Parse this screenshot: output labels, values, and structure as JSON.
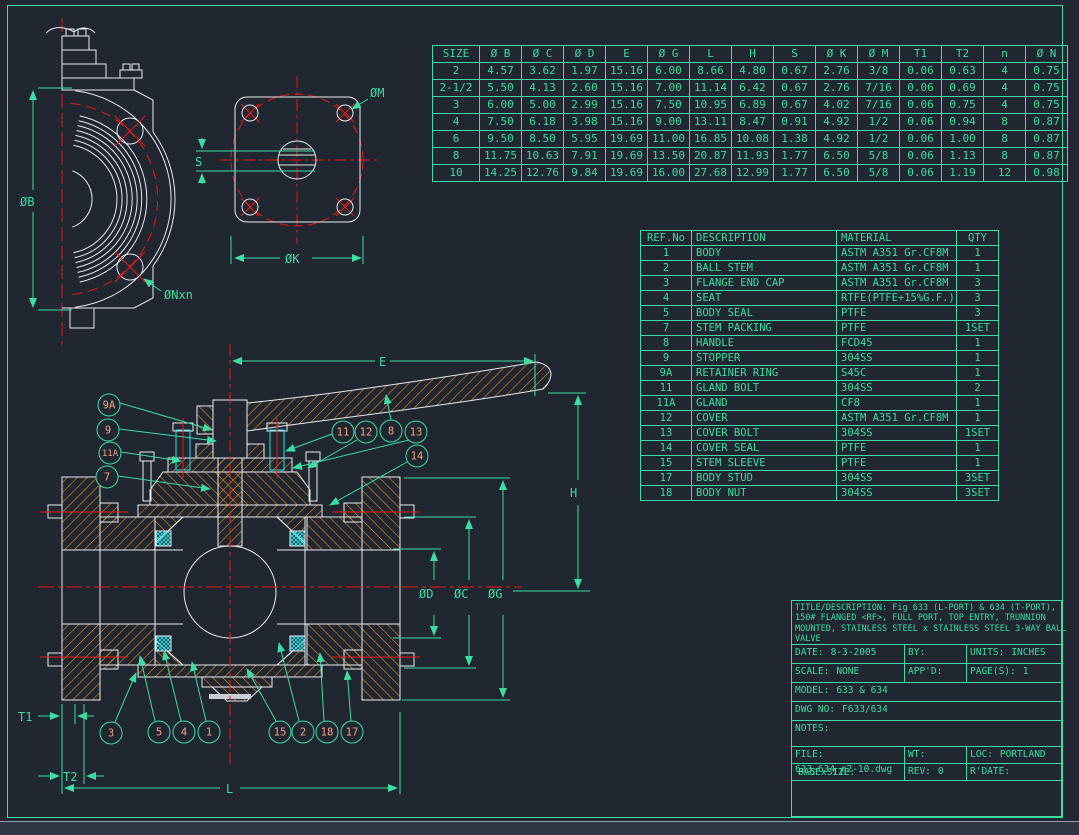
{
  "colors": {
    "background": "#202730",
    "green": "#3CDCA4",
    "white": "#E8ECEF",
    "red": "#E81818",
    "orange": "#E98A1B",
    "cyan": "#25E0E8",
    "salmon": "#F0A183",
    "taskbar": "#2E3642"
  },
  "size_table": {
    "headers": [
      "SIZE",
      "Ø B",
      "Ø C",
      "Ø D",
      "E",
      "Ø G",
      "L",
      "H",
      "S",
      "Ø K",
      "Ø M",
      "T1",
      "T2",
      "n",
      "Ø N"
    ],
    "rows": [
      [
        "2",
        "4.57",
        "3.62",
        "1.97",
        "15.16",
        "6.00",
        "8.66",
        "4.80",
        "0.67",
        "2.76",
        "3/8",
        "0.06",
        "0.63",
        "4",
        "0.75"
      ],
      [
        "2-1/2",
        "5.50",
        "4.13",
        "2.60",
        "15.16",
        "7.00",
        "11.14",
        "6.42",
        "0.67",
        "2.76",
        "7/16",
        "0.06",
        "0.69",
        "4",
        "0.75"
      ],
      [
        "3",
        "6.00",
        "5.00",
        "2.99",
        "15.16",
        "7.50",
        "10.95",
        "6.89",
        "0.67",
        "4.02",
        "7/16",
        "0.06",
        "0.75",
        "4",
        "0.75"
      ],
      [
        "4",
        "7.50",
        "6.18",
        "3.98",
        "15.16",
        "9.00",
        "13.11",
        "8.47",
        "0.91",
        "4.92",
        "1/2",
        "0.06",
        "0.94",
        "8",
        "0.87"
      ],
      [
        "6",
        "9.50",
        "8.50",
        "5.95",
        "19.69",
        "11.00",
        "16.85",
        "10.08",
        "1.38",
        "4.92",
        "1/2",
        "0.06",
        "1.00",
        "8",
        "0.87"
      ],
      [
        "8",
        "11.75",
        "10.63",
        "7.91",
        "19.69",
        "13.50",
        "20.87",
        "11.93",
        "1.77",
        "6.50",
        "5/8",
        "0.06",
        "1.13",
        "8",
        "0.87"
      ],
      [
        "10",
        "14.25",
        "12.76",
        "9.84",
        "19.69",
        "16.00",
        "27.68",
        "12.99",
        "1.77",
        "6.50",
        "5/8",
        "0.06",
        "1.19",
        "12",
        "0.98"
      ]
    ]
  },
  "bom_table": {
    "headers": [
      "REF.No",
      "DESCRIPTION",
      "MATERIAL",
      "QTY"
    ],
    "rows": [
      [
        "1",
        "BODY",
        "ASTM A351 Gr.CF8M",
        "1"
      ],
      [
        "2",
        "BALL STEM",
        "ASTM A351 Gr.CF8M",
        "1"
      ],
      [
        "3",
        "FLANGE END CAP",
        "ASTM A351 Gr.CF8M",
        "3"
      ],
      [
        "4",
        "SEAT",
        "RTFE(PTFE+15%G.F.)",
        "3"
      ],
      [
        "5",
        "BODY SEAL",
        "PTFE",
        "3"
      ],
      [
        "7",
        "STEM PACKING",
        "PTFE",
        "1SET"
      ],
      [
        "8",
        "HANDLE",
        "FCD45",
        "1"
      ],
      [
        "9",
        "STOPPER",
        "304SS",
        "1"
      ],
      [
        "9A",
        "RETAINER RING",
        "S45C",
        "1"
      ],
      [
        "11",
        "GLAND BOLT",
        "304SS",
        "2"
      ],
      [
        "11A",
        "GLAND",
        "CF8",
        "1"
      ],
      [
        "12",
        "COVER",
        "ASTM A351 Gr.CF8M",
        "1"
      ],
      [
        "13",
        "COVER BOLT",
        "304SS",
        "1SET"
      ],
      [
        "14",
        "COVER SEAL",
        "PTFE",
        "1"
      ],
      [
        "15",
        "STEM SLEEVE",
        "PTFE",
        "1"
      ],
      [
        "17",
        "BODY STUD",
        "304SS",
        "3SET"
      ],
      [
        "18",
        "BODY NUT",
        "304SS",
        "3SET"
      ]
    ]
  },
  "title_block": {
    "title_lines": [
      "TITLE/DESCRIPTION: Fig 633 (L-PORT) & 634 (T-PORT),",
      "150# FLANGED <RF>, FULL PORT, TOP ENTRY, TRUNNION",
      "MOUNTED, STAINLESS STEEL x STAINLESS STEEL 3-WAY BALL",
      "VALVE"
    ],
    "date_label": "DATE:",
    "date": "8-3-2005",
    "by_label": "BY:",
    "units_label": "UNITS:",
    "units": "INCHES",
    "scale_label": "SCALE:",
    "scale": "NONE",
    "appd_label": "APP'D:",
    "pages_label": "PAGE(S):",
    "pages": "1",
    "model_label": "MODEL:",
    "model": "633 & 634",
    "dwg_label": "DWG NO:",
    "dwg_no": "F633/634",
    "notes_label": "NOTES:",
    "file_label": "FILE:",
    "file_overlap": "633-634 r2-10.dwg",
    "wt_label": "WT:",
    "loc_label": "LOC:",
    "loc": "PORTLAND",
    "page_size_label": "PAGE SIZE:",
    "page_size": "8.5 x 11L",
    "rev_label": "REV:",
    "rev": "0",
    "rdate_label": "R'DATE:"
  },
  "drawing": {
    "balloons_top": [
      "9A",
      "9",
      "11A",
      "7",
      "11",
      "12",
      "8",
      "13",
      "14"
    ],
    "balloons_bottom": [
      "3",
      "5",
      "4",
      "1",
      "15",
      "2",
      "18",
      "17"
    ],
    "dims": {
      "b": "ØB",
      "nxn": "ØNxn",
      "s": "S",
      "m": "ØM",
      "k": "ØK",
      "e": "E",
      "h": "H",
      "d": "ØD",
      "c": "ØC",
      "g": "ØG",
      "t1": "T1",
      "t2": "T2",
      "l": "L"
    }
  }
}
